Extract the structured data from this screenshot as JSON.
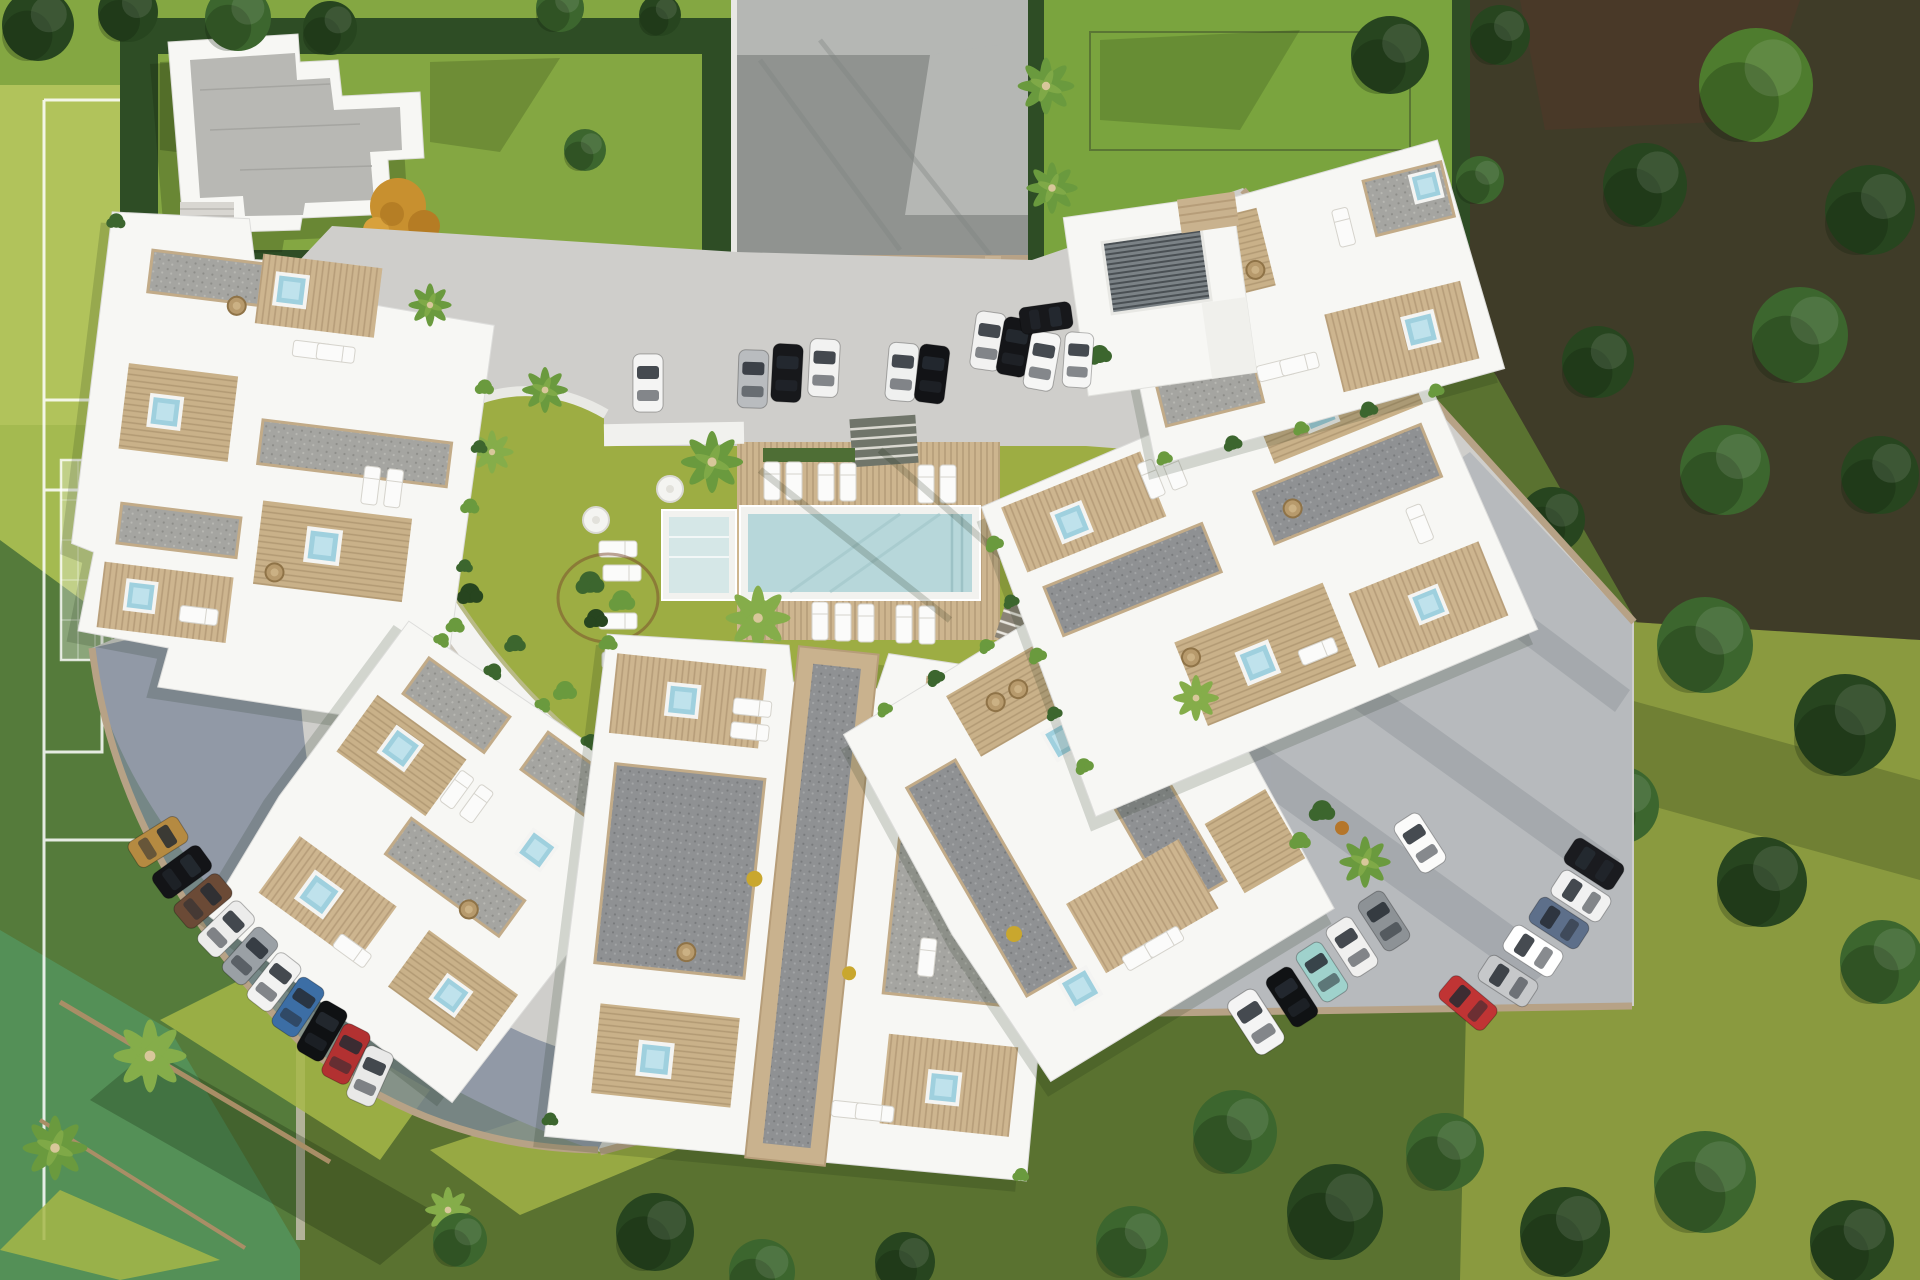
{
  "meta": {
    "type": "aerial-architectural-render",
    "subject": "Top-down 3D render of a crescent-shaped white apartment complex with central pool, gardens, sports field and parking"
  },
  "palette": {
    "field_light": "#b2c45c",
    "field_mid": "#a4ba50",
    "field_shadow": "#4e7539",
    "field_teal": "#549158",
    "line_white": "#ffffff",
    "lawn_bright": "#84a742",
    "lawn_topright": "#7aa43e",
    "lawn_olive": "#9dad43",
    "lawn_right": "#8a9a3f",
    "lawn_bottom": "#5a7230",
    "patch_yellow": "#a6b748",
    "hedge": "#2e4d25",
    "tree_dark": "#27451f",
    "tree_mid": "#3c662e",
    "tree_bright": "#4e7c2e",
    "palm": "#6a9a3e",
    "palm_light": "#85ad4a",
    "forest_floor": "#3f3c28",
    "soil_red": "#4a3828",
    "road_light": "#cfcecb",
    "road_gray": "#909390",
    "road_pale": "#b5b7b4",
    "parking_shadow": "#7f8b9b",
    "parking_right": "#b4b8bb",
    "wall_tan": "#b7a286",
    "deck_wood": "#cdb58f",
    "building_white": "#f7f7f4",
    "building_shade": "#e7e7e3",
    "roof_gray": "#b8b8b4",
    "pool_water": "#b7d7da",
    "pool_steps": "#d5e7e7",
    "jacuzzi": "#9fd0de",
    "gate_dark": "#34383b",
    "orange_tree": "#c8902f",
    "trunk": "#a98e66",
    "wicker": "#b79a6c"
  },
  "cars": {
    "top_road": [
      "#f4f4f3",
      "#b9bcbf",
      "#17181b",
      "#f2f2f1",
      "#eff0ef",
      "#121316",
      "#f2f2f1",
      "#141518",
      "#f6f6f5"
    ],
    "entry_east": [
      "#17181b",
      "#f6f6f5"
    ],
    "southwest_row": [
      "#b58a41",
      "#131417",
      "#6b4a36",
      "#ececeb",
      "#9aa0a5",
      "#f2f2f1",
      "#3c6ea5",
      "#0f1113",
      "#b23131",
      "#e9e9e8"
    ],
    "southeast_row": [
      "#f4f4f4",
      "#101214",
      "#9fd2cc",
      "#f0f0ef",
      "#8d9296",
      "#fbfbfa"
    ],
    "east_column": [
      "#1a1b1f",
      "#f1f1f1",
      "#5d6f8a",
      "#ffffff",
      "#c6c8ca",
      "#c03434"
    ]
  },
  "counts": {
    "top_road_cars": 9,
    "entry_cars": 2,
    "southwest_cars": 10,
    "southeast_cars": 6,
    "east_column_cars": 6,
    "building_clusters": 6
  }
}
